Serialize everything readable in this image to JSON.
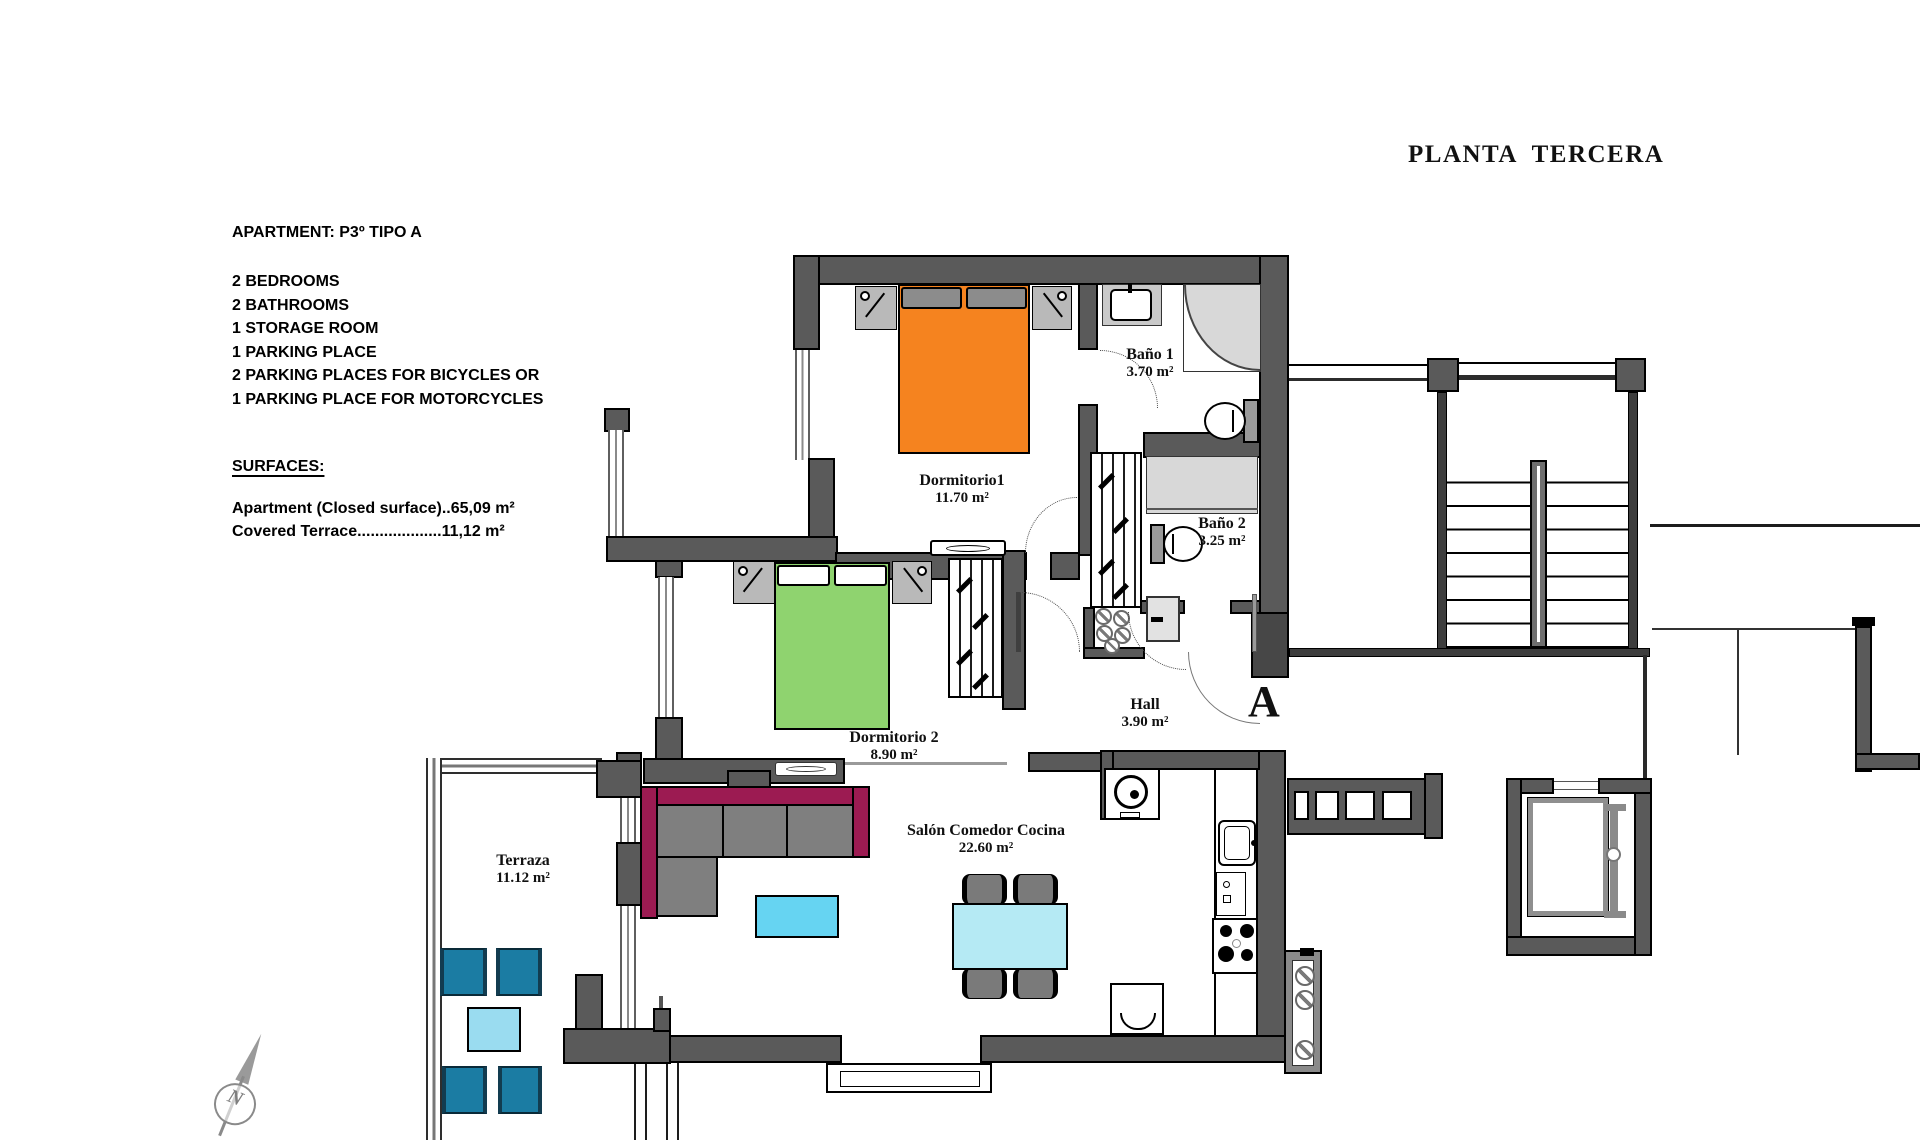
{
  "title": "PLANTA  TERCERA",
  "info": {
    "apartment_line": "APARTMENT: P3º TIPO A",
    "features": [
      "2 BEDROOMS",
      "2 BATHROOMS",
      "1 STORAGE ROOM",
      "1 PARKING PLACE",
      "2 PARKING PLACES FOR BICYCLES OR",
      "1 PARKING PLACE FOR MOTORCYCLES"
    ],
    "surfaces_heading": "SURFACES:",
    "surfaces": [
      "Apartment (Closed surface)..65,09 m²",
      "Covered Terrace...................11,12 m²"
    ]
  },
  "rooms": {
    "dormitorio1": {
      "name": "Dormitorio1",
      "area": "11.70 m²"
    },
    "bano1": {
      "name": "Baño 1",
      "area": "3.70 m²"
    },
    "bano2": {
      "name": "Baño 2",
      "area": "3.25 m²"
    },
    "dormitorio2": {
      "name": "Dormitorio 2",
      "area": "8.90 m²"
    },
    "hall": {
      "name": "Hall",
      "area": "3.90 m²"
    },
    "salon": {
      "name": "Salón Comedor Cocina",
      "area": "22.60 m²"
    },
    "terraza": {
      "name": "Terraza",
      "area": "11.12 m²"
    }
  },
  "apartment_letter": "A",
  "compass_letter": "N",
  "colors": {
    "wall_gray": "#5a5a5a",
    "bed1_orange": "#f5831f",
    "bed2_green": "#8fd36f",
    "sofa_magenta": "#9c1b52",
    "coffee_table_cyan": "#66d4f2",
    "dining_table_cyan": "#b5eaf4",
    "terrace_chair_teal": "#1b7ca3",
    "terrace_table_cyan": "#9adcf0"
  }
}
